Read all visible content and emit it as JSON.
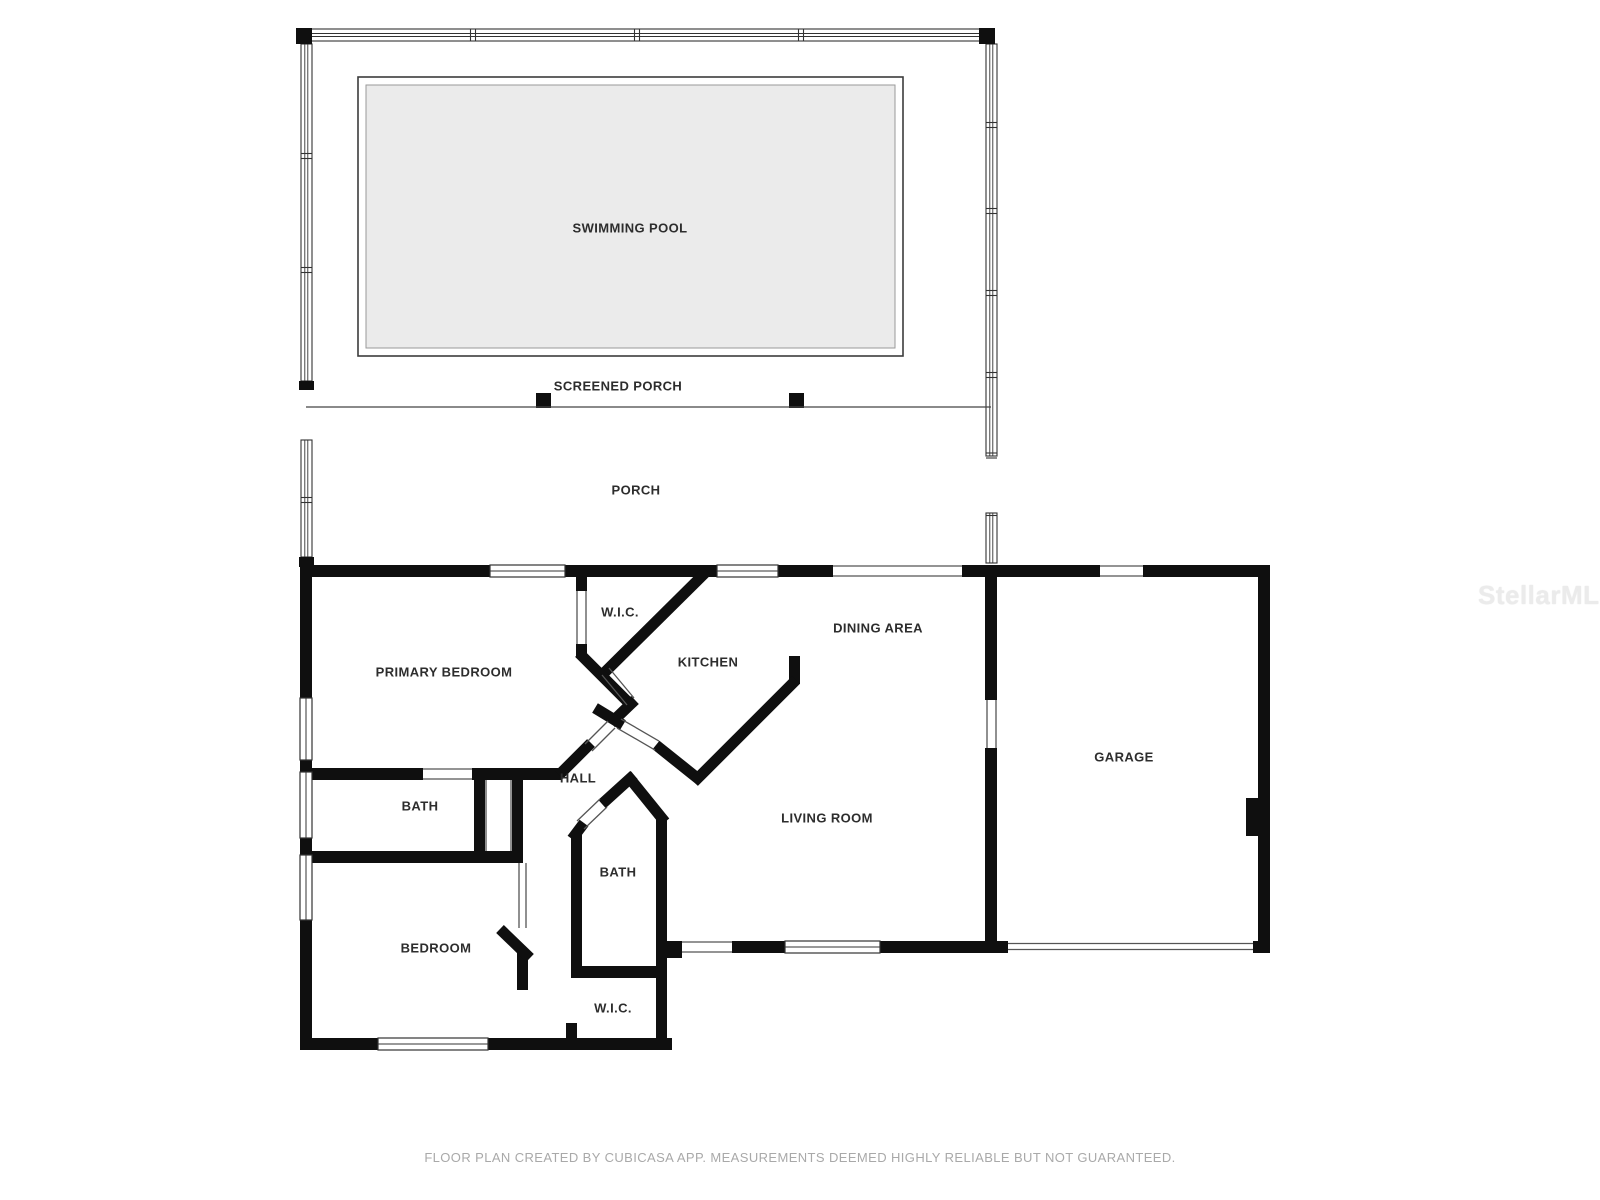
{
  "rooms": {
    "swimming_pool": {
      "label": "SWIMMING POOL"
    },
    "screened_porch": {
      "label": "SCREENED PORCH"
    },
    "porch": {
      "label": "PORCH"
    },
    "wic_top": {
      "label": "W.I.C."
    },
    "primary_bedroom": {
      "label": "PRIMARY BEDROOM"
    },
    "kitchen": {
      "label": "KITCHEN"
    },
    "dining_area": {
      "label": "DINING AREA"
    },
    "garage": {
      "label": "GARAGE"
    },
    "bath_upper": {
      "label": "BATH"
    },
    "hall": {
      "label": "HALL"
    },
    "living_room": {
      "label": "LIVING ROOM"
    },
    "bath_lower": {
      "label": "BATH"
    },
    "bedroom": {
      "label": "BEDROOM"
    },
    "wic_bottom": {
      "label": "W.I.C."
    }
  },
  "watermark": {
    "text": "StellarMLS"
  },
  "footer": {
    "text": "FLOOR PLAN CREATED BY CUBICASA APP. MEASUREMENTS DEEMED HIGHLY RELIABLE BUT NOT GUARANTEED."
  },
  "colors": {
    "wall": "#0f0f0f",
    "pool_fill": "#ebebeb",
    "label_text": "#2d2d2d",
    "footer_text": "#a9a9a9",
    "watermark_text": "#ebebeb"
  }
}
